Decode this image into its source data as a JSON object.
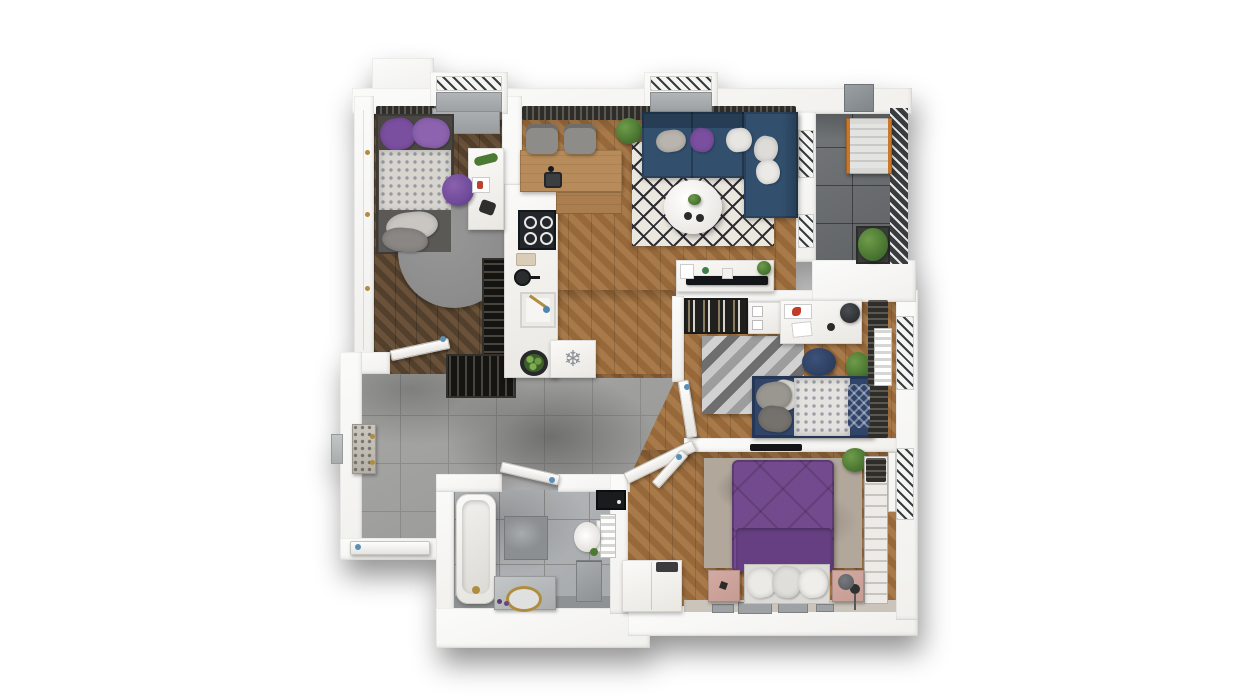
{
  "scene": {
    "description": "Photorealistic 3D top-down floor plan rendering of a two-bedroom apartment with balcony",
    "background": "#ffffff",
    "no_visible_text": true
  },
  "icons": {
    "fridge_snowflake": "❄"
  },
  "palette": {
    "wall": "#f1f0ed",
    "wall_bright": "#fbfbfa",
    "wood_dark_a": "#53402c",
    "wood_dark_b": "#6a523a",
    "wood_light_a": "#a87a4a",
    "wood_light_b": "#96683a",
    "wood_counter": "#b88c5a",
    "tile_hall_a": "#a8a8a6",
    "tile_hall_b": "#949492",
    "tile_bath_a": "#b7babc",
    "tile_bath_b": "#a6a9ab",
    "tile_balcony_a": "#74777a",
    "tile_balcony_b": "#606366",
    "grout": "#8b8b89",
    "sofa_navy": "#32506e",
    "sofa_navy_dark": "#263d55",
    "purple": "#7b4fa0",
    "purple_chair": "#6f4b9b",
    "bed_purple": "#744a8e",
    "bed_purple_dark": "#663f82",
    "rug_light": "#eae7df",
    "rug_diamond": "#2e2d33",
    "rug_gray": "#8c8c8c",
    "rug_master": "#b2a79b",
    "kid_rug_a": "#9d9d9d",
    "kid_rug_b": "#d2d2d2",
    "kid_navy": "#31456b",
    "pink": "#c59c93",
    "gray_furn": "#8e8c89",
    "dark_unit": "#232321",
    "curtain_dark": "#2f2d2a",
    "curtain_mid": "#5b5751",
    "green": "#4d7a33",
    "green_dark": "#38592a",
    "gold": "#b08d3e",
    "black_tv": "#141518",
    "appliance_gray": "#9b9ea0",
    "steel": "#3c3f41",
    "orange": "#c9782a",
    "window_dark": "#3a3d40",
    "handle_blue": "#5a8fb8",
    "headboard_beige": "#cbc4ba",
    "frame_gray": "#9fa2a4"
  },
  "rooms": [
    {
      "id": "bedroom-office",
      "floor": "dark-herringbone-wood",
      "items": [
        "single-bed-purple-bedding",
        "round-gray-rug",
        "purple-desk-chair",
        "white-desk",
        "bottle-rack",
        "built-in-closet",
        "window-bay",
        "curtain",
        "window-sill-bench"
      ]
    },
    {
      "id": "kitchen",
      "floor": "oak-chevron-wood",
      "items": [
        "l-shaped-wood-counter",
        "two-bar-chairs",
        "induction-cooktop",
        "corner-sink-faucet",
        "white-sink",
        "fridge-freezer-snowflake",
        "potted-plant",
        "white-base-cabinets",
        "curtain"
      ]
    },
    {
      "id": "living-room",
      "floor": "oak-chevron-wood",
      "items": [
        "navy-corner-sofa",
        "throw-pillows",
        "black-white-diamond-rug",
        "round-coffee-table",
        "tv-console",
        "potted-plant",
        "window-bay",
        "balcony-door-panels",
        "curtain"
      ]
    },
    {
      "id": "balcony",
      "floor": "dark-gray-tiles",
      "items": [
        "lounge-chair-orange-rails",
        "corner-planter",
        "railing",
        "ac-unit"
      ]
    },
    {
      "id": "kids-bedroom",
      "floor": "oak-chevron-wood",
      "items": [
        "single-bed-navy-white-bedding",
        "gray-chevron-rug",
        "navy-pouf",
        "bookshelf",
        "storage-boxes",
        "white-desk",
        "desk-chair",
        "potted-plant",
        "radiator",
        "window",
        "curtain"
      ]
    },
    {
      "id": "master-bedroom",
      "floor": "oak-chevron-wood",
      "items": [
        "double-bed-purple-bedding",
        "mottled-gray-rug",
        "pink-nightstand-left",
        "pink-nightstand-right",
        "white-dresser",
        "open-wardrobe-shelves",
        "wall-mounted-tv",
        "floor-lamp",
        "potted-plant",
        "picture-frames",
        "window"
      ]
    },
    {
      "id": "bathroom",
      "floor": "light-gray-tiles",
      "items": [
        "bathtub-gold-faucet",
        "stone-vanity-gold-basin",
        "toilet",
        "washing-machine",
        "towel-radiator",
        "black-mirror-cabinet",
        "dark-tile-panel",
        "small-plant"
      ]
    },
    {
      "id": "hallway",
      "floor": "gray-tiles",
      "items": [
        "entrance-door",
        "speckled-shoe-cabinet",
        "bottle-rack-niche",
        "bedroom-door",
        "bathroom-door",
        "kids-room-door",
        "master-room-door",
        "exterior-panel"
      ]
    }
  ]
}
